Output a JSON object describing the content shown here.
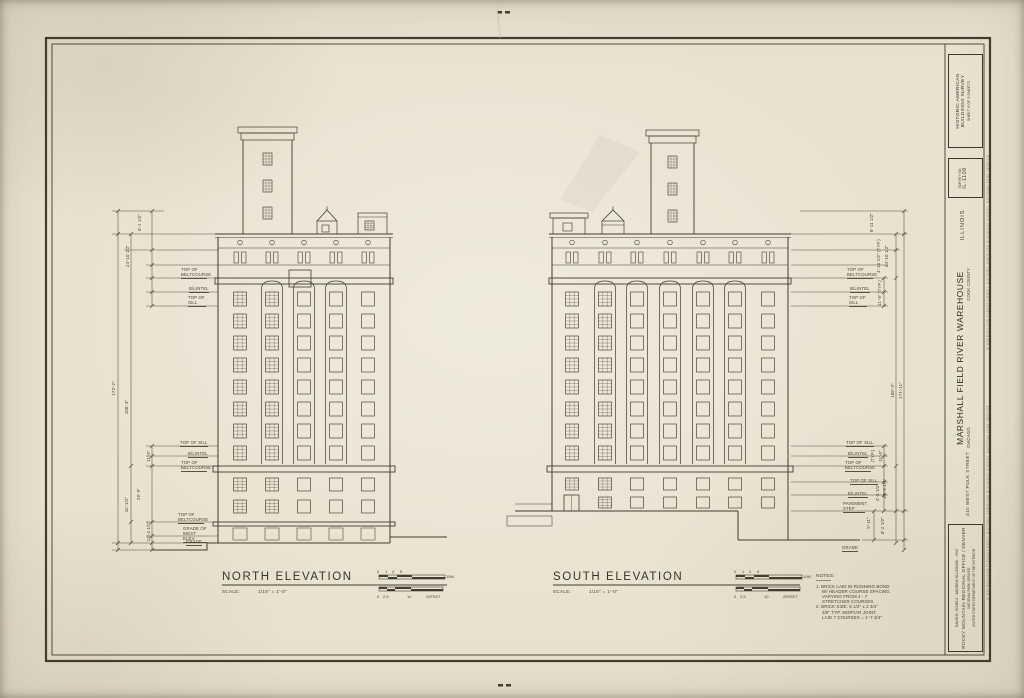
{
  "paper": {
    "background": "#e8e2d0",
    "ink": "#433c2f"
  },
  "titleblock": {
    "agency_line1": "HISTORIC AMERICAN",
    "agency_line2": "BUILDINGS SURVEY",
    "sheet_info": "SHEET 6 OF 9 SHEETS",
    "survey_label": "SURVEY NO.",
    "survey_no": "IL-1108",
    "state": "ILLINOIS",
    "building_name": "MARSHALL FIELD RIVER WAREHOUSE",
    "city": "CHICAGO",
    "county": "COOK COUNTY",
    "address": "310 WEST POLK STREET",
    "credit_names": "DAVID B. SCHELZ · ANDREW KLUSINSKI · 1992",
    "office": "ROCKY MOUNTAIN REGIONAL OFFICE / DENVER",
    "nps": "NATIONAL PARK SERVICE",
    "dept": "UNITED STATES DEPARTMENT OF THE INTERIOR",
    "edge_credit": "IF REPRODUCED PLEASE CREDIT: HISTORIC AMERICAN BUILDINGS SURVEY, NATIONAL PARK SERVICE"
  },
  "north": {
    "title": "NORTH ELEVATION",
    "scale_label": "SCALE:",
    "scale_value": "1/16\" = 1'-0\""
  },
  "south": {
    "title": "SOUTH ELEVATION",
    "scale_label": "SCALE:",
    "scale_value": "1/16\" = 1'-0\""
  },
  "scale_bar": {
    "m0": "0",
    "m1": "1",
    "m2": "2",
    "m5": "5",
    "m10": "10M",
    "f0": "0",
    "f25": "2.5",
    "f10": "10",
    "f20": "20FEET"
  },
  "notes": {
    "title": "NOTES:",
    "l1": "1. BRICK LAID IN RUNNING BOND",
    "l2": "W/ HEADER COURSE SPACING",
    "l3": "VARYING FROM 4 - 7",
    "l4": "STRETCHER COURSES",
    "l5": "2. BRICK SIZE: 8 1/2\" x 2 3/4\"",
    "l6": "3/8\" TYP. MORTAR JOINT.",
    "l7": "LAID 7 COURSES = 1'-7 3/4\""
  },
  "dims": {
    "n61": "6'-1 1/2\"",
    "n2410": "24'-10 1/2\"",
    "n173": "173'-2\"",
    "n108": "108'-3\"",
    "n119": "11'-9\"",
    "n42": "42'-1/2\"",
    "n29": "29'-9\"",
    "n1245": "12'-4 1/2\"",
    "top_belt": "TOP OF BELTCOURSE",
    "blintel": "B/LINTEL",
    "top_sill": "TOP OF SILL",
    "grade_west": "GRADE OF WEST ELEV.",
    "grade": "GRADE",
    "pavement": "PAVEMENT STEP",
    "typ": "(TYP.)",
    "s611": "6'-11 1/2\"",
    "s4102": "4'-10 1/2\" (TYP.)",
    "s2410": "24'-10 1/2\"",
    "styp119": "11'-9\" (TYP.)",
    "s108": "108'-3\"",
    "s171": "171'-11\"",
    "s119": "11'-9\"",
    "s2092": "20'-9 1/2\"",
    "s452": "4'-5 1/2\"",
    "s911": "9'-11\"",
    "s821": "8'-2 1/2\""
  }
}
